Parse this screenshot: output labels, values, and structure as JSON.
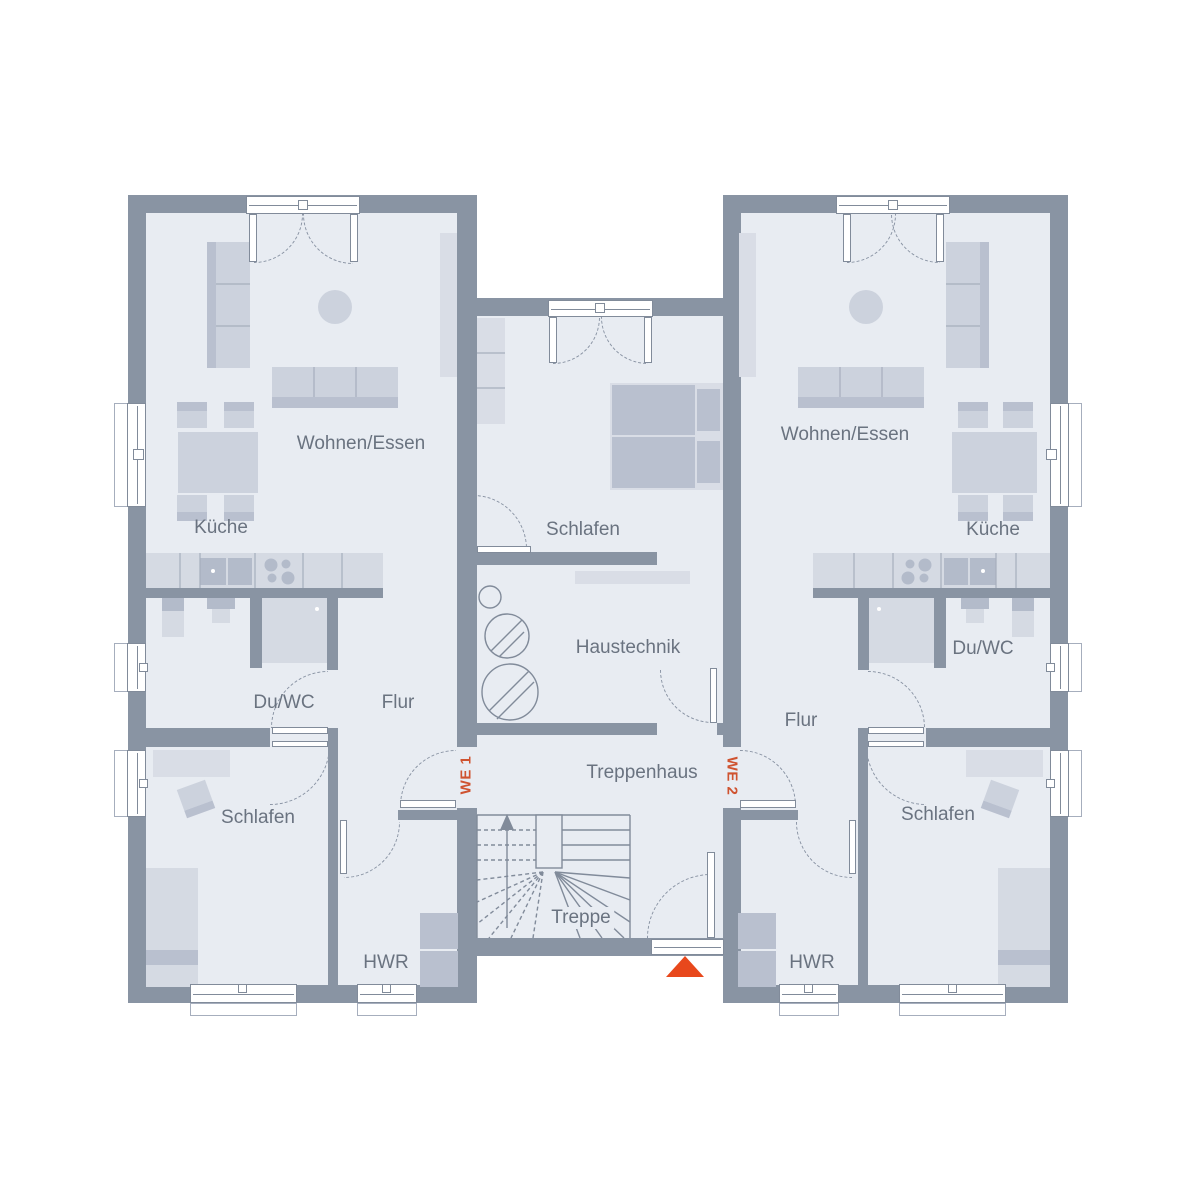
{
  "plan": {
    "unit1": {
      "tag": "WE 1",
      "rooms": {
        "wohnen_essen": "Wohnen/Essen",
        "kueche": "Küche",
        "du_wc": "Du/WC",
        "flur": "Flur",
        "schlafen": "Schlafen",
        "hwr": "HWR"
      }
    },
    "unit2": {
      "tag": "WE 2",
      "rooms": {
        "wohnen_essen": "Wohnen/Essen",
        "kueche": "Küche",
        "du_wc": "Du/WC",
        "flur": "Flur",
        "schlafen": "Schlafen",
        "hwr": "HWR"
      }
    },
    "common": {
      "schlafen": "Schlafen",
      "haustechnik": "Haustechnik",
      "treppenhaus": "Treppenhaus",
      "treppe": "Treppe"
    }
  },
  "icons": {
    "entrance_marker_icon": "orange triangle pointing up at main entrance",
    "stair_up_arrow_icon": "arrow showing stair direction up"
  },
  "colors": {
    "wall": "#8994a3",
    "floor": "#e8ecf2",
    "furn": "#ccd2dd",
    "furn_mid": "#b9c0cf",
    "counter": "#d5dae3",
    "appliance": "#b3bbca",
    "shelf": "#d9dde6",
    "line": "#818b9a",
    "div_line": "#a6aebd",
    "text": "#6a7380",
    "accent": "#cf5330",
    "triangle": "#e8481c"
  }
}
